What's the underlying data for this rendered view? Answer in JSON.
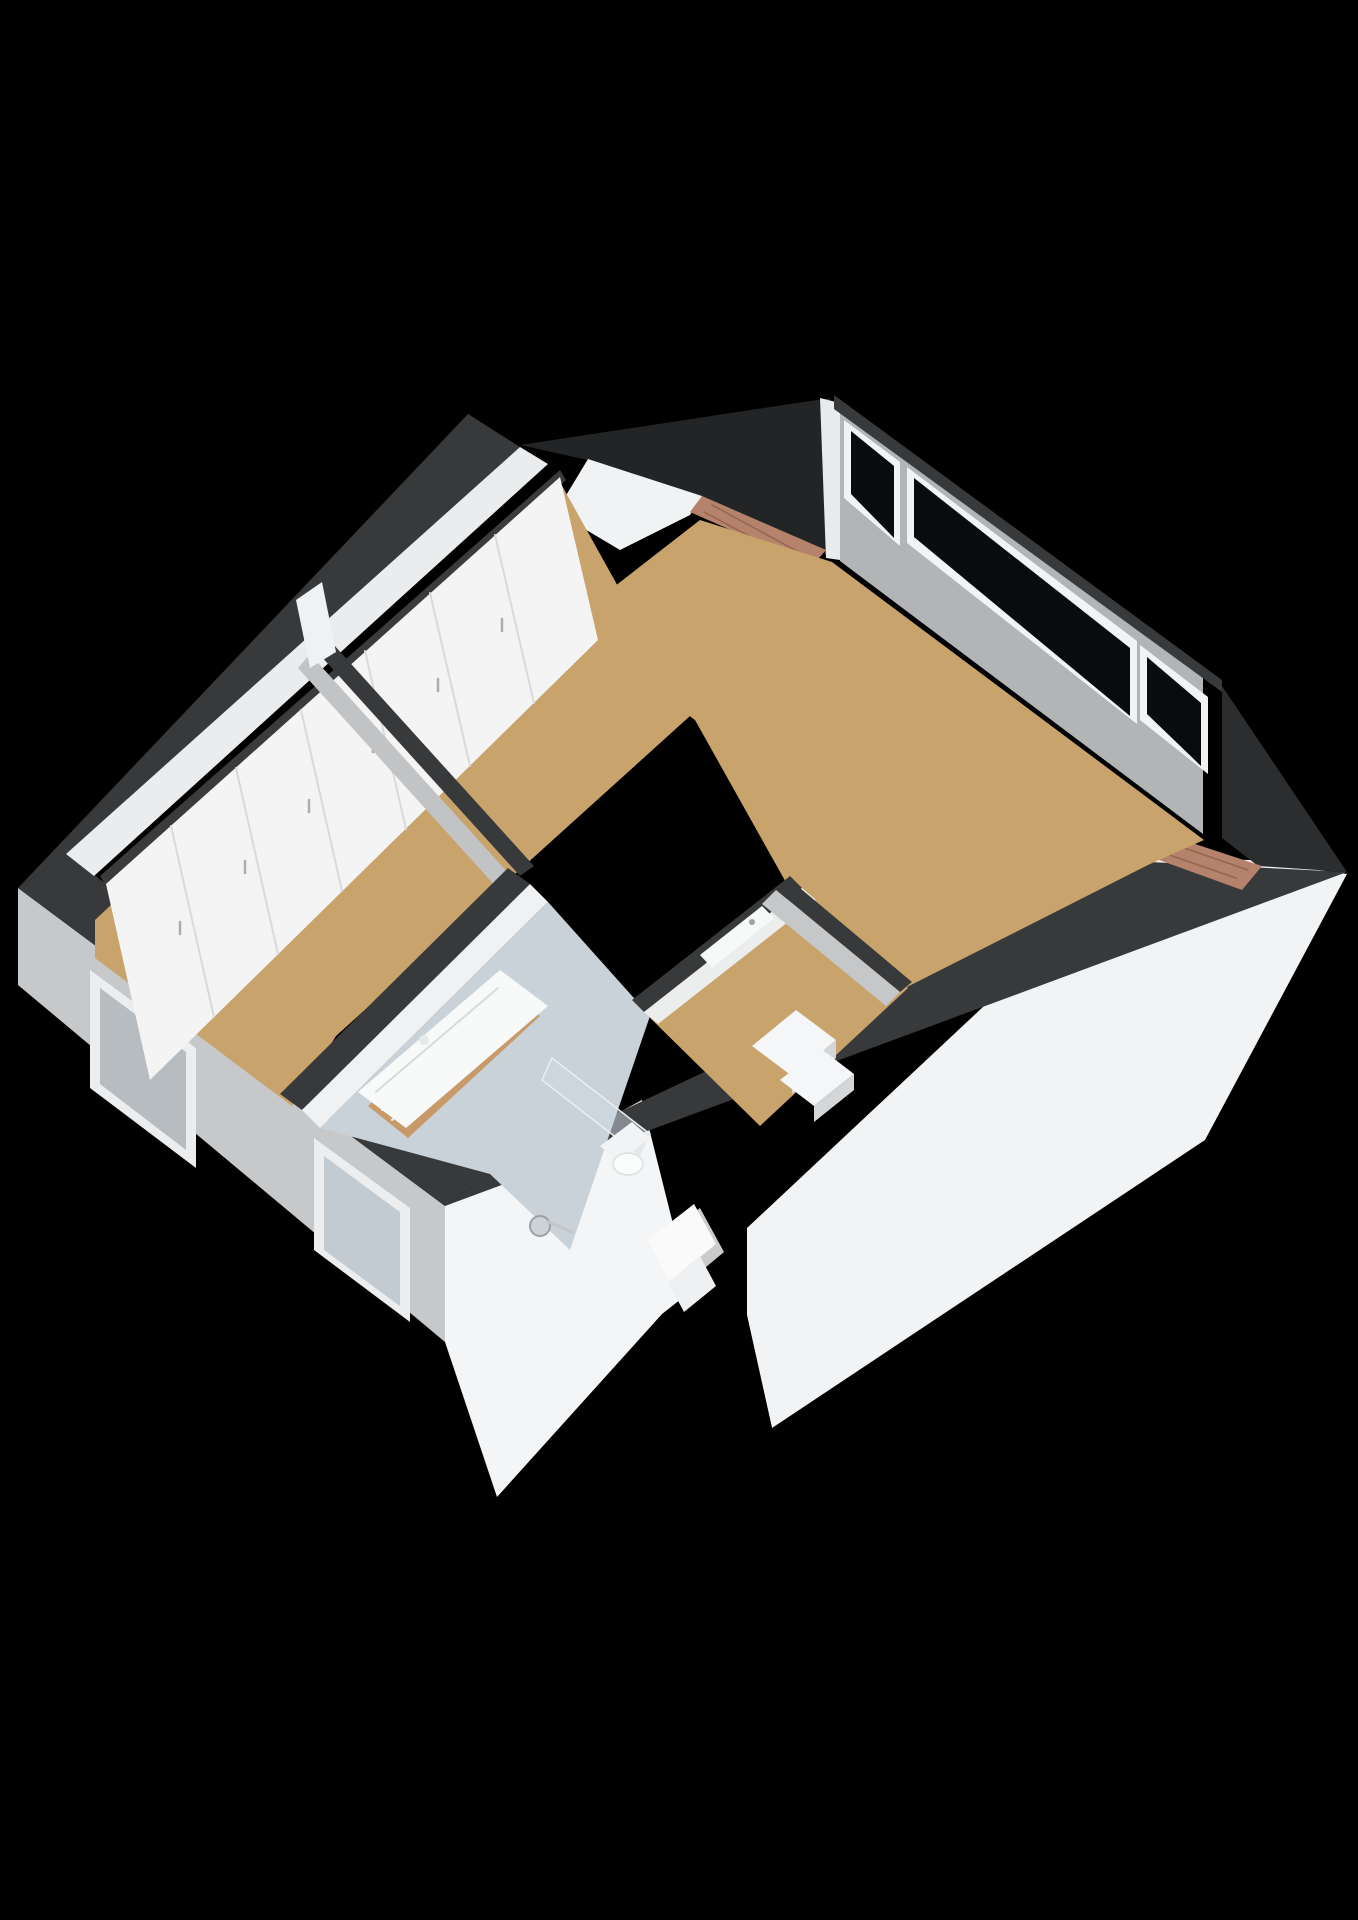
{
  "palette": {
    "background": "#000000",
    "wall_top_cut": "#38393B",
    "roof_slope_dark": "#232425",
    "roof_slope_white": "#F2F3F4",
    "exterior_wall_gray": "#C6C8CA",
    "interior_wall_white": "#F1F2F3",
    "interior_wall_shadow": "#C2C3C5",
    "floor_wood": "#C8A36C",
    "floor_bathroom": "#C9D2D9",
    "window_glass_dark": "#0A0B0C",
    "window_frame_white": "#F2F3F4",
    "dormer_brick": "#B5826B",
    "brick_joint": "#96664F",
    "vanity_wood": "#C89A6A",
    "fixture_white": "#F8F9F9"
  },
  "scene": {
    "width": 1358,
    "height": 1920,
    "shapes": [
      {
        "name": "background",
        "type": "polygon",
        "fill": "#000000",
        "points": "0,0 1358,0 1358,1920 0,1920"
      },
      {
        "name": "roof-slope-right",
        "type": "polygon",
        "fill": "#F2F3F4",
        "points": "747,1228 1142,858 1250,860 1347,874 1205,1140 772,1428 747,1315"
      },
      {
        "name": "roof-gap-shadow",
        "type": "polygon",
        "fill": "#000000",
        "points": "688,1290 747,1226 747,1316 772,1428 700,1360 660,1314"
      },
      {
        "name": "facade-gable",
        "type": "polygon",
        "fill": "#F4F5F6",
        "points": "445,1206 642,1100 690,1292 662,1314 497,1497 445,1342"
      },
      {
        "name": "facade-chimney-shadow",
        "type": "polygon",
        "fill": "#C9CBCD",
        "points": "652,1244 700,1208 724,1252 676,1292"
      },
      {
        "name": "facade-chimney",
        "type": "polygon",
        "fill": "#FAFAFB",
        "points": "648,1240 694,1204 716,1244 670,1282"
      },
      {
        "name": "facade-chimney-step",
        "type": "polygon",
        "fill": "#EFF0F1",
        "points": "668,1282 700,1256 716,1286 684,1312"
      },
      {
        "name": "exterior-wall-sw",
        "type": "polygon",
        "fill": "#C6C8CA",
        "points": "18,888 445,1206 445,1342 18,985"
      },
      {
        "name": "window-a-frame",
        "type": "polygon",
        "fill": "#ECEDEE",
        "points": "90,970 196,1048 196,1168 90,1088"
      },
      {
        "name": "window-a-pane",
        "type": "polygon",
        "fill": "#B6BCC0",
        "points": "100,988 186,1052 186,1150 100,1084"
      },
      {
        "name": "window-b-frame",
        "type": "polygon",
        "fill": "#ECEDEE",
        "points": "314,1138 410,1208 410,1322 314,1250"
      },
      {
        "name": "window-b-pane",
        "type": "polygon",
        "fill": "#C2CBD2",
        "points": "324,1156 400,1212 400,1306 324,1250"
      },
      {
        "name": "wall-top-band-sw",
        "type": "polygon",
        "fill": "#38393B",
        "points": "18,888 445,1206 492,1172 66,854"
      },
      {
        "name": "wall-top-band-nw",
        "type": "polygon",
        "fill": "#38393B",
        "points": "18,888 468,414 520,447 66,854"
      },
      {
        "name": "inner-wall-stripe-nw",
        "type": "polygon",
        "fill": "#EBECED",
        "points": "66,854 520,447 548,464 94,876"
      },
      {
        "name": "roof-slope-back-dark",
        "type": "polygon",
        "fill": "#232425",
        "points": "520,445 830,398 830,558 820,550 698,497 588,460"
      },
      {
        "name": "dormer-left-gable",
        "type": "polygon",
        "fill": "#F1F2F3",
        "points": "588,459 702,496 690,515 620,550 556,512"
      },
      {
        "name": "dormer-left-roof",
        "type": "polygon",
        "fill": "#B5826B",
        "points": "702,496 826,550 812,566 690,512"
      },
      {
        "name": "dormer-left-roof-line-1",
        "type": "line",
        "stroke": "#96664F",
        "sw": 1.5,
        "x1": 712,
        "y1": 505,
        "x2": 806,
        "y2": 556
      },
      {
        "name": "dormer-left-roof-line-2",
        "type": "line",
        "stroke": "#96664F",
        "sw": 1.5,
        "x1": 704,
        "y1": 512,
        "x2": 798,
        "y2": 562
      },
      {
        "name": "window-wall-edge",
        "type": "polygon",
        "fill": "#E9EAEB",
        "points": "820,398 840,403 840,560 826,558"
      },
      {
        "name": "window-wall-face",
        "type": "polygon",
        "fill": "#B2B4B6",
        "points": "840,403 1203,678 1203,834 840,561"
      },
      {
        "name": "window-wall-cap",
        "type": "polygon",
        "fill": "#38393B",
        "points": "834,395 1222,680 1222,692 834,409"
      },
      {
        "name": "window-1-frame",
        "type": "polygon",
        "fill": "#F2F3F4",
        "points": "844,420 900,462 900,546 844,498"
      },
      {
        "name": "window-1-pane",
        "type": "polygon",
        "fill": "#0A0B0C",
        "points": "851,431 894,466 894,538 851,494"
      },
      {
        "name": "window-2-frame",
        "type": "polygon",
        "fill": "#F2F3F4",
        "points": "907,467 1137,641 1137,724 907,543"
      },
      {
        "name": "window-2-pane",
        "type": "polygon",
        "fill": "#0A0B0C",
        "points": "914,478 1130,648 1130,716 914,537"
      },
      {
        "name": "window-3-frame",
        "type": "polygon",
        "fill": "#F2F3F4",
        "points": "1140,645 1208,697 1208,774 1140,720"
      },
      {
        "name": "window-3-pane",
        "type": "polygon",
        "fill": "#0A0B0C",
        "points": "1147,657 1201,703 1201,766 1147,714"
      },
      {
        "name": "roof-edge-ne-dark",
        "type": "polygon",
        "fill": "#2C2D2F",
        "points": "1222,686 1347,872 1258,866 1222,838"
      },
      {
        "name": "wall-top-band-se",
        "type": "polygon",
        "fill": "#38393B",
        "points": "445,1206 492,1172 1150,862 1347,872"
      },
      {
        "name": "dormer-right-sliver",
        "type": "polygon",
        "fill": "#EDEEEF",
        "points": "1104,824 1240,862 1232,872 1096,834"
      },
      {
        "name": "dormer-right-roof",
        "type": "polygon",
        "fill": "#B5826B",
        "points": "1122,820 1262,866 1242,890 1104,840"
      },
      {
        "name": "dormer-right-roof-line-1",
        "type": "line",
        "stroke": "#96664F",
        "sw": 1.5,
        "x1": 1132,
        "y1": 830,
        "x2": 1248,
        "y2": 870
      },
      {
        "name": "dormer-right-roof-line-2",
        "type": "line",
        "stroke": "#96664F",
        "sw": 1.5,
        "x1": 1120,
        "y1": 838,
        "x2": 1236,
        "y2": 878
      },
      {
        "name": "floor-bedroom",
        "type": "polygon",
        "fill": "#C8A36C",
        "points": "95,920 560,482 690,716 336,1036 292,1106 95,958"
      },
      {
        "name": "floor-main-room",
        "type": "polygon",
        "fill": "#C8A36C",
        "points": "565,625 700,520 832,562 1204,840 1150,864 905,988 788,886 695,720"
      },
      {
        "name": "floor-landing",
        "type": "polygon",
        "fill": "#C8A36C",
        "points": "640,1008 788,886 908,988 760,1126"
      },
      {
        "name": "floor-bathroom",
        "type": "polygon",
        "fill": "#C9D2D9",
        "points": "320,1128 548,902 650,1016 570,1250 490,1174"
      },
      {
        "name": "wardrobe-top-dark",
        "type": "polygon",
        "fill": "#3A3B3D",
        "points": "100,876 560,470 566,480 106,886"
      },
      {
        "name": "wardrobe-front",
        "type": "polygon",
        "fill": "#F4F4F5",
        "points": "106,884 560,477 598,640 150,1080"
      },
      {
        "name": "wardrobe-door-line-1",
        "type": "line",
        "stroke": "#D9DADB",
        "sw": 2,
        "x1": 171,
        "y1": 826,
        "x2": 214,
        "y2": 1017
      },
      {
        "name": "wardrobe-door-line-2",
        "type": "line",
        "stroke": "#D9DADB",
        "sw": 2,
        "x1": 236,
        "y1": 768,
        "x2": 278,
        "y2": 954
      },
      {
        "name": "wardrobe-door-line-3",
        "type": "line",
        "stroke": "#D9DADB",
        "sw": 2,
        "x1": 301,
        "y1": 710,
        "x2": 342,
        "y2": 891
      },
      {
        "name": "wardrobe-door-line-4",
        "type": "line",
        "stroke": "#D9DADB",
        "sw": 2,
        "x1": 365,
        "y1": 651,
        "x2": 406,
        "y2": 829
      },
      {
        "name": "wardrobe-door-line-5",
        "type": "line",
        "stroke": "#D9DADB",
        "sw": 2,
        "x1": 430,
        "y1": 593,
        "x2": 470,
        "y2": 766
      },
      {
        "name": "wardrobe-door-line-6",
        "type": "line",
        "stroke": "#D9DADB",
        "sw": 2,
        "x1": 495,
        "y1": 535,
        "x2": 534,
        "y2": 703
      },
      {
        "name": "wardrobe-handle-1",
        "type": "line",
        "stroke": "#AAACAE",
        "sw": 2.5,
        "x1": 180,
        "y1": 922,
        "x2": 180,
        "y2": 934
      },
      {
        "name": "wardrobe-handle-2",
        "type": "line",
        "stroke": "#AAACAE",
        "sw": 2.5,
        "x1": 245,
        "y1": 861,
        "x2": 245,
        "y2": 873
      },
      {
        "name": "wardrobe-handle-3",
        "type": "line",
        "stroke": "#AAACAE",
        "sw": 2.5,
        "x1": 309,
        "y1": 800,
        "x2": 309,
        "y2": 812
      },
      {
        "name": "wardrobe-handle-4",
        "type": "line",
        "stroke": "#AAACAE",
        "sw": 2.5,
        "x1": 373,
        "y1": 740,
        "x2": 373,
        "y2": 752
      },
      {
        "name": "wardrobe-handle-5",
        "type": "line",
        "stroke": "#AAACAE",
        "sw": 2.5,
        "x1": 438,
        "y1": 679,
        "x2": 438,
        "y2": 691
      },
      {
        "name": "wardrobe-handle-6",
        "type": "line",
        "stroke": "#AAACAE",
        "sw": 2.5,
        "x1": 502,
        "y1": 619,
        "x2": 502,
        "y2": 631
      },
      {
        "name": "wall-bedroom-main-top",
        "type": "polygon",
        "fill": "#38393B",
        "points": "310,644 520,876 534,866 324,634"
      },
      {
        "name": "wall-bedroom-main-face",
        "type": "polygon",
        "fill": "#C2C3C5",
        "points": "310,654 520,886 508,900 298,668"
      },
      {
        "name": "wall-end-cap",
        "type": "polygon",
        "fill": "#F0F1F2",
        "points": "296,600 322,582 336,652 310,668"
      },
      {
        "name": "wall-bedroom-bath-top",
        "type": "polygon",
        "fill": "#38393B",
        "points": "280,1094 508,868 530,884 302,1110"
      },
      {
        "name": "wall-bedroom-bath-face",
        "type": "polygon",
        "fill": "#F0F1F2",
        "points": "302,1110 530,884 548,902 320,1128"
      },
      {
        "name": "wall-landing-nw-top",
        "type": "polygon",
        "fill": "#38393B",
        "points": "632,1000 790,876 802,888 644,1012"
      },
      {
        "name": "wall-landing-nw-face",
        "type": "polygon",
        "fill": "#ECEDED",
        "points": "644,1012 802,888 816,900 658,1024"
      },
      {
        "name": "landing-door-leaf",
        "type": "polygon",
        "fill": "#F7F8F8",
        "points": "700,955 762,906 774,918 712,968"
      },
      {
        "name": "landing-door-handle",
        "type": "circle",
        "fill": "#9FA1A3",
        "cx": 752,
        "cy": 922,
        "r": 3
      },
      {
        "name": "wall-landing-ne-top",
        "type": "polygon",
        "fill": "#38393B",
        "points": "788,878 912,982 900,992 776,890"
      },
      {
        "name": "wall-landing-ne-face",
        "type": "polygon",
        "fill": "#C6C7C9",
        "points": "776,890 900,992 886,1006 762,904"
      },
      {
        "name": "vanity-cabinet",
        "type": "polygon",
        "fill": "#C89A6A",
        "points": "368,1106 500,984 540,1016 408,1138"
      },
      {
        "name": "vanity-slat-1",
        "type": "line",
        "stroke": "#F2F3F4",
        "sw": 2,
        "x1": 382,
        "y1": 1110,
        "x2": 506,
        "y2": 994
      },
      {
        "name": "vanity-slat-2",
        "type": "line",
        "stroke": "#F2F3F4",
        "sw": 2,
        "x1": 392,
        "y1": 1120,
        "x2": 516,
        "y2": 1004
      },
      {
        "name": "vanity-sink-top",
        "type": "polygon",
        "fill": "#F8F9F9",
        "points": "358,1092 500,970 548,1006 406,1128"
      },
      {
        "name": "vanity-basin-line",
        "type": "line",
        "stroke": "#D9DADB",
        "sw": 2,
        "x1": 376,
        "y1": 1092,
        "x2": 498,
        "y2": 988
      },
      {
        "name": "vanity-faucet",
        "type": "circle",
        "fill": "#E8E9EA",
        "cx": 424,
        "cy": 1040,
        "r": 5
      },
      {
        "name": "shower-glass-panel",
        "type": "polygon",
        "fill": "rgba(205,218,228,0.5)",
        "stroke": "#EDEEEF",
        "sw": 1.5,
        "points": "552,1058 650,1134 640,1156 542,1080"
      },
      {
        "name": "shower-drain",
        "type": "circle",
        "fill": "#CDD4D9",
        "stroke": "#9AA0A4",
        "sw": 2,
        "cx": 540,
        "cy": 1226,
        "r": 10
      },
      {
        "name": "shower-drain-lever",
        "type": "line",
        "stroke": "#C2C6C9",
        "sw": 3,
        "x1": 548,
        "y1": 1222,
        "x2": 572,
        "y2": 1232
      },
      {
        "name": "toilet-tank",
        "type": "polygon",
        "fill": "#F2F3F4",
        "points": "600,1146 632,1122 650,1138 618,1162"
      },
      {
        "name": "toilet-bowl",
        "type": "ellipse",
        "fill": "#FAFBFB",
        "stroke": "#DDDEDF",
        "sw": 1.5,
        "cx": 628,
        "cy": 1164,
        "rx": 15,
        "ry": 11
      },
      {
        "name": "stair-step-1-top",
        "type": "polygon",
        "fill": "#F5F6F7",
        "points": "752,1046 796,1010 836,1040 792,1076"
      },
      {
        "name": "stair-step-1-riser",
        "type": "polygon",
        "fill": "#D5D6D8",
        "points": "792,1076 836,1040 836,1058 792,1094"
      },
      {
        "name": "stair-step-2-top",
        "type": "polygon",
        "fill": "#F5F6F7",
        "points": "780,1080 820,1048 854,1074 814,1106"
      },
      {
        "name": "stair-step-2-riser",
        "type": "polygon",
        "fill": "#D5D6D8",
        "points": "814,1106 854,1074 854,1090 814,1122"
      }
    ]
  }
}
